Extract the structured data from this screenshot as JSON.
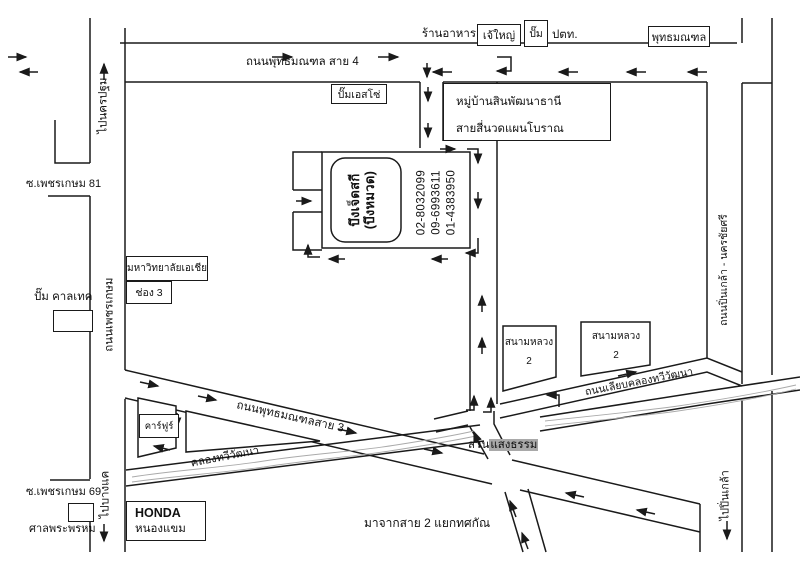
{
  "colors": {
    "ink": "#1a1a1a",
    "paper": "#ffffff",
    "canal_water": "#a9a9a9",
    "label_highlight": "#a9a9a9"
  },
  "top_row": {
    "restaurant": "ร้านอาหาร",
    "jaeyai": "เจ้ใหญ่",
    "pump": "ปั๊ม",
    "ptt": "ปตท.",
    "phutthamonthon": "พุทธมณฑล"
  },
  "roads": {
    "sai4": "ถนนพุทธมณฑล สาย 4",
    "sai3": "ถนนพุทธมณฑลสาย 3",
    "phetkasem": "ถนนเพชรเกษม",
    "to_nakhon_pathom": "ไปนครปฐม",
    "to_bang_khae": "ไปบางแค",
    "soi81": "ซ.เพชรเกษม 81",
    "soi69": "ซ.เพชรเกษม 69",
    "canal_road": "ถนนเลียบคลองทวีวัฒนา",
    "canal": "คลองทวีวัฒนา",
    "pinklao": "ถนนปิ่นเกล้า - นครชัยศรี",
    "to_pinklao": "ไปปิ่นเกล้า",
    "from_sai2": "มาจากสาย 2 แยกทศกัณ"
  },
  "places": {
    "esso": "ปั๊มเอสโซ่",
    "village_line1": "หมู่บ้านสินพัฒนาธานี",
    "village_line2": "สายสี่นวดแผนโบราณ",
    "university": "มหาวิทยาลัยเอเชีย",
    "channel3": "ช่อง 3",
    "caltex": "ปั๊ม คาลเทค",
    "carrefour": "คาร์ฟูร์",
    "sanam_luang_a_1": "สนามหลวง",
    "sanam_luang_a_2": "2",
    "sanam_luang_b_1": "สนามหลวง",
    "sanam_luang_b_2": "2",
    "suan_prefix": "สวน",
    "suan_highlight": "แสงธรรม",
    "honda_line1": "HONDA",
    "honda_line2": "หนองแขม",
    "brahma_shrine": "ศาลพระพรหม"
  },
  "destination": {
    "title_line1": "บึงเจ็ดสกี",
    "title_line2": "(บึงหมวด)",
    "phones": [
      "02-8032099",
      "09-6993611",
      "01-4383950"
    ]
  }
}
